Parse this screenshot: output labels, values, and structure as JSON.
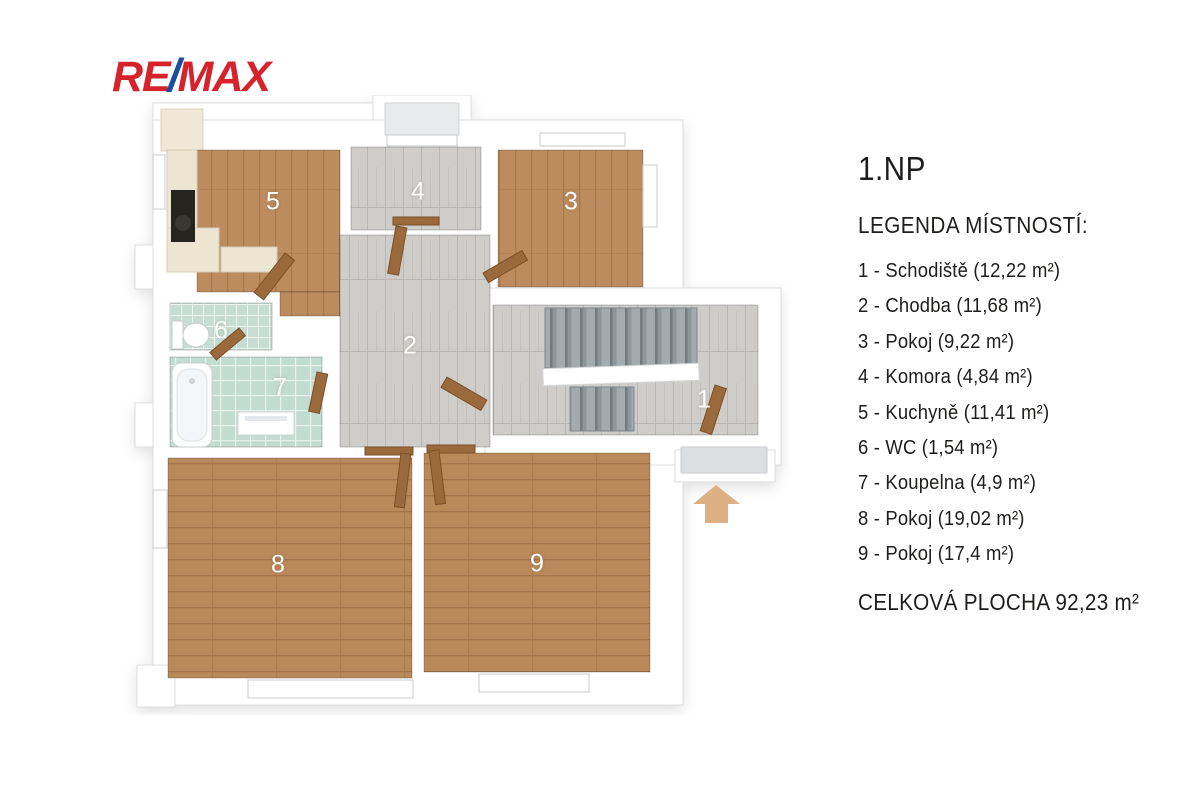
{
  "logo": {
    "re": "RE",
    "slash": "/",
    "max": "MAX"
  },
  "legend": {
    "floor_title": "1.NP",
    "heading": "LEGENDA MÍSTNOSTÍ:",
    "items": [
      "1 - Schodiště (12,22 m²)",
      "2 - Chodba (11,68 m²)",
      "3 - Pokoj (9,22 m²)",
      "4 - Komora (4,84 m²)",
      "5 - Kuchyně (11,41 m²)",
      "6 - WC (1,54 m²)",
      "7 - Koupelna (4,9 m²)",
      "8 - Pokoj (19,02 m²)",
      "9 - Pokoj (17,4 m²)"
    ],
    "total": "CELKOVÁ PLOCHA 92,23 m²"
  },
  "plan": {
    "room_numbers": [
      "1",
      "2",
      "3",
      "4",
      "5",
      "6",
      "7",
      "8",
      "9"
    ]
  },
  "colors": {
    "logo_red": "#d6232b",
    "logo_blue": "#1b4da0",
    "wood_floor": "#bc8c5e",
    "gray_tile": "#cfcdca",
    "bathroom_tile": "#c4ddd2",
    "stairs": "#9aa3a6",
    "door_wood": "#9a6a3d",
    "entrance_arrow": "#ddb083",
    "kitchen_counter": "#ece5d2",
    "wall": "#ffffff",
    "text": "#1d1d1b"
  }
}
